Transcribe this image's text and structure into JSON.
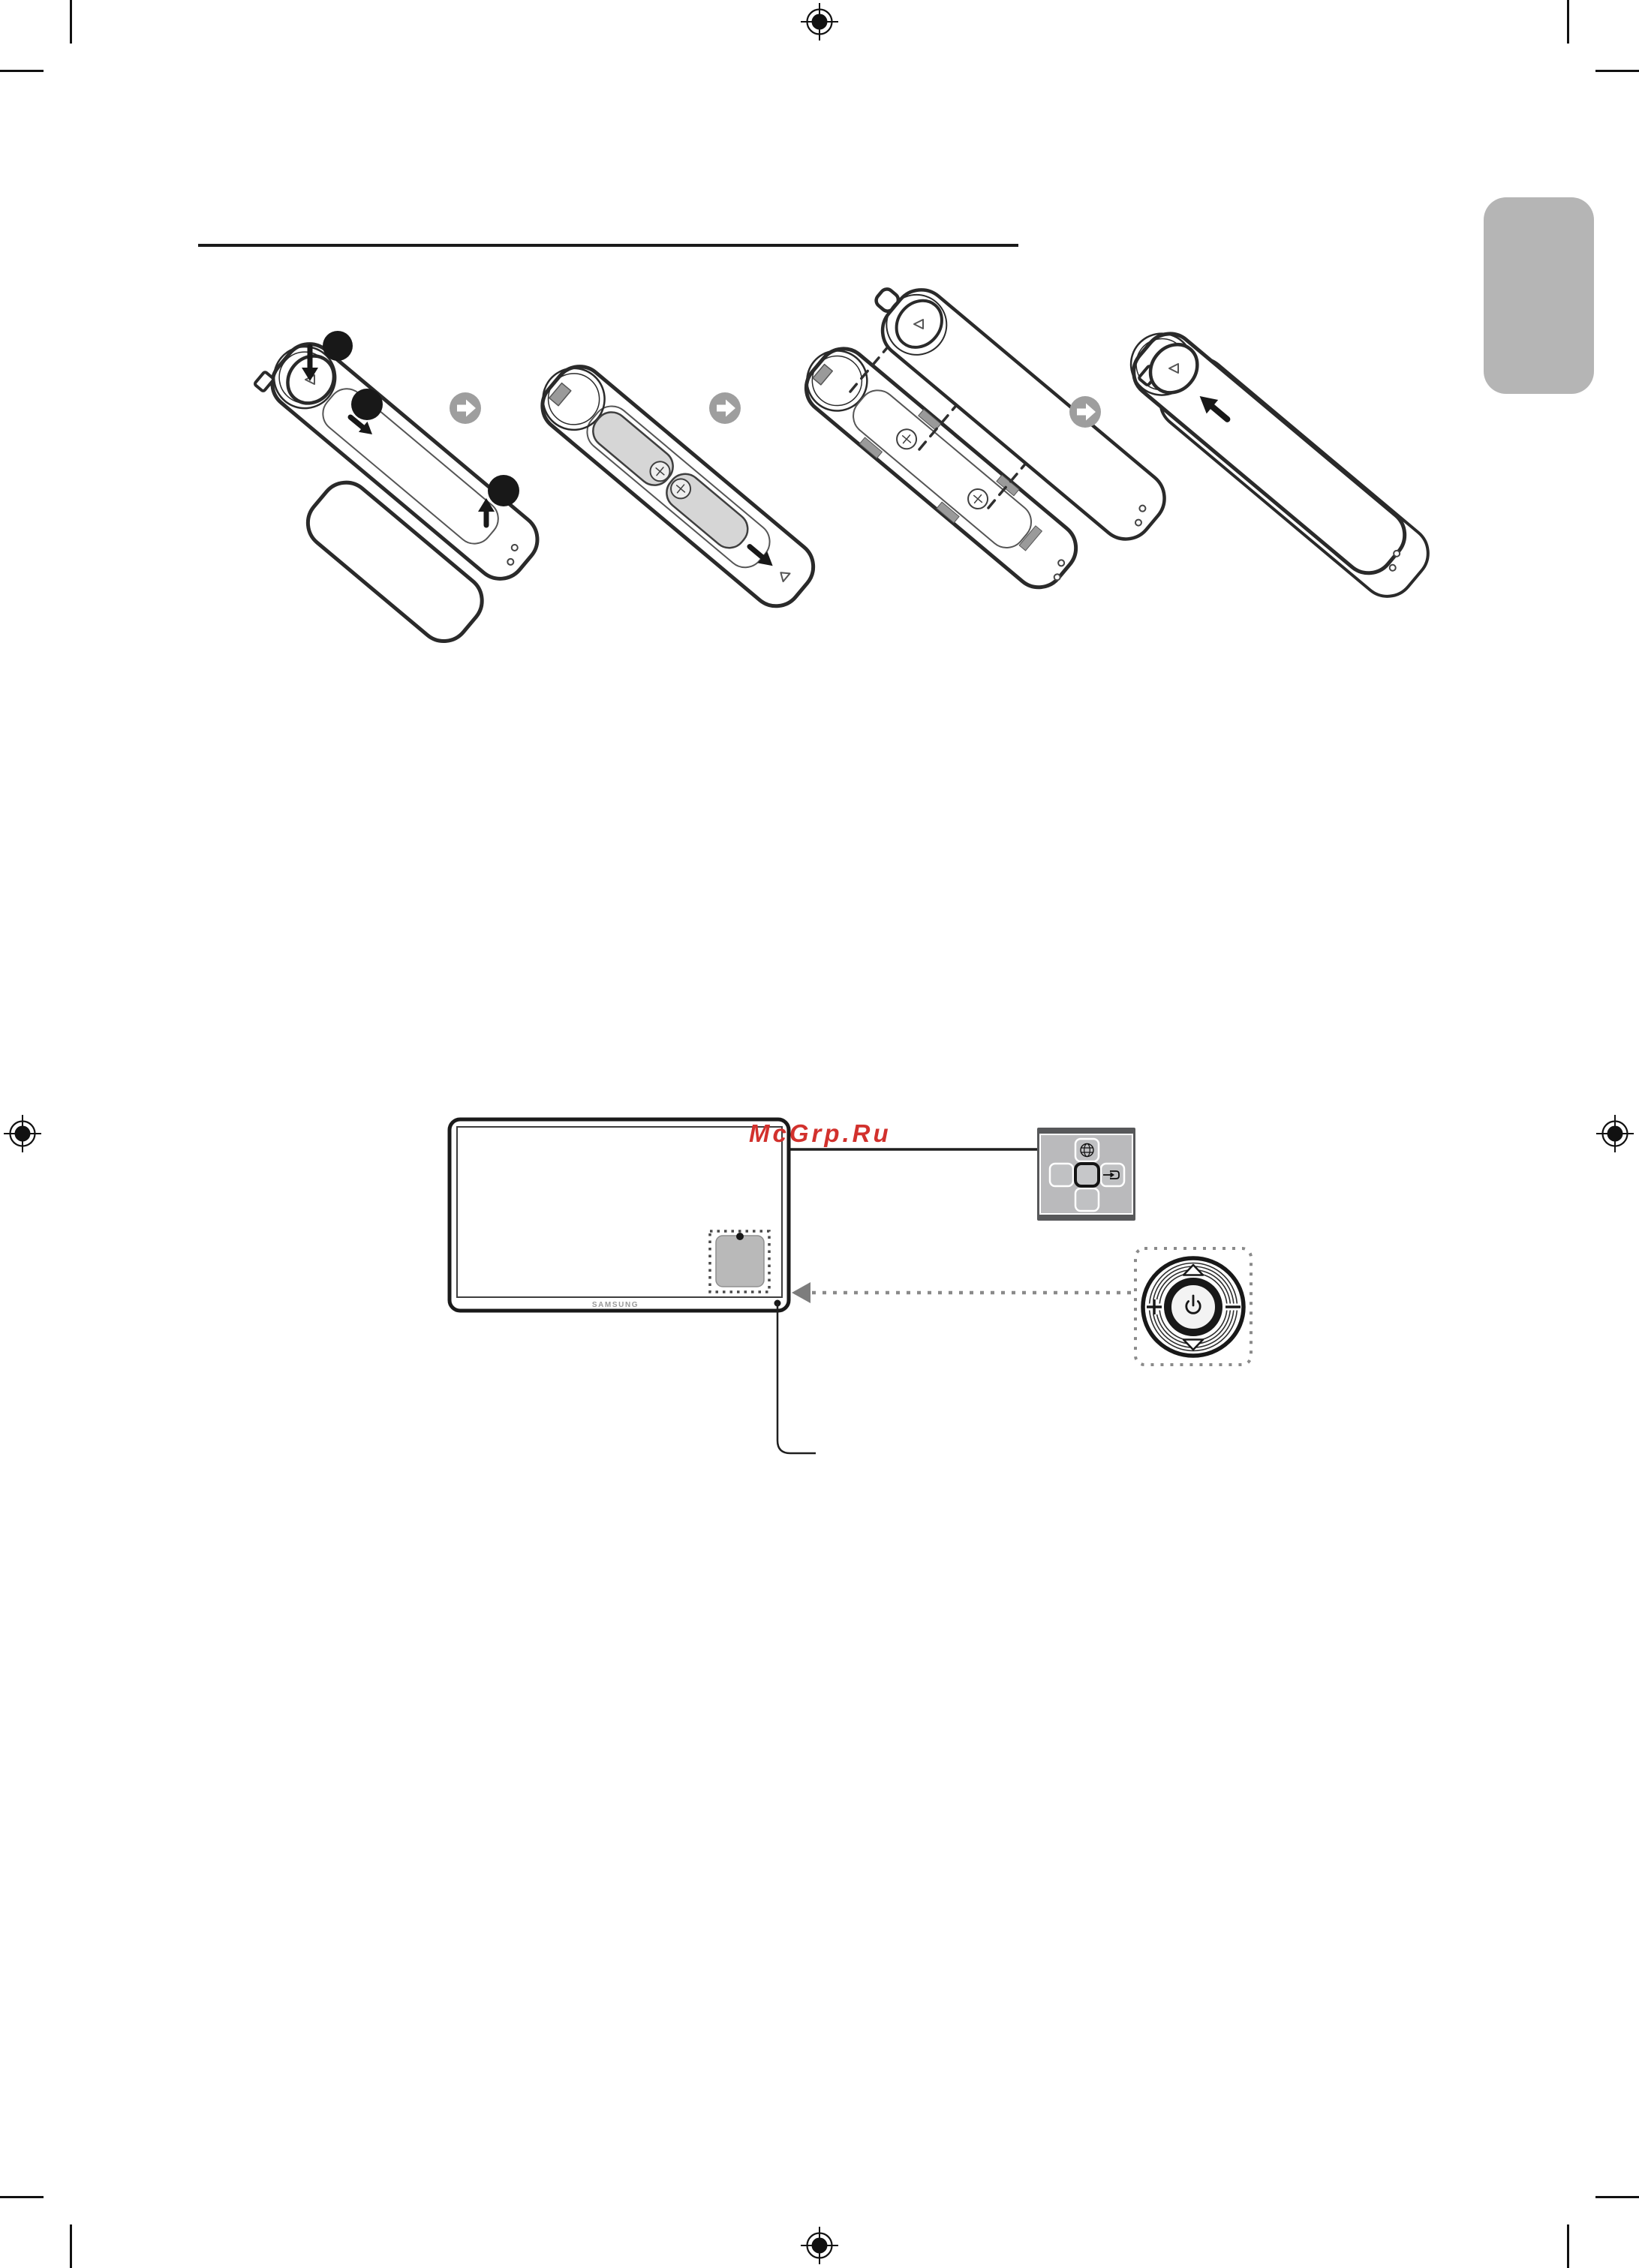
{
  "page": {
    "type": "printed-manual-scan",
    "background": "#ffffff"
  },
  "watermark": {
    "text": "McGrp.Ru",
    "color": "#d2312d"
  },
  "tv": {
    "brand_label": "SAMSUNG",
    "brand_color": "#9a9a9a"
  },
  "section_rule": {
    "color": "#1a1a1a"
  },
  "side_tab": {
    "color": "#b5b5b5"
  },
  "battery_figure": {
    "panel_count": 4,
    "marker_dot_count": 3,
    "step_arrow_icon": "next-step-arrow-icon",
    "step_arrow_color": "#9e9e9e"
  },
  "control_panel": {
    "frame_color": "#57585a",
    "body_color": "#bababc",
    "icons": [
      "menu-globe-icon",
      "source-enter-icon"
    ]
  },
  "jog_button": {
    "icons": [
      "up-triangle-icon",
      "plus-icon",
      "power-icon",
      "minus-icon",
      "down-triangle-icon"
    ],
    "dotted_outline_color": "#8a8a8a"
  },
  "print_marks": {
    "registration_mark_count": 4,
    "crop_mark_corners": 4,
    "color": "#111111"
  }
}
